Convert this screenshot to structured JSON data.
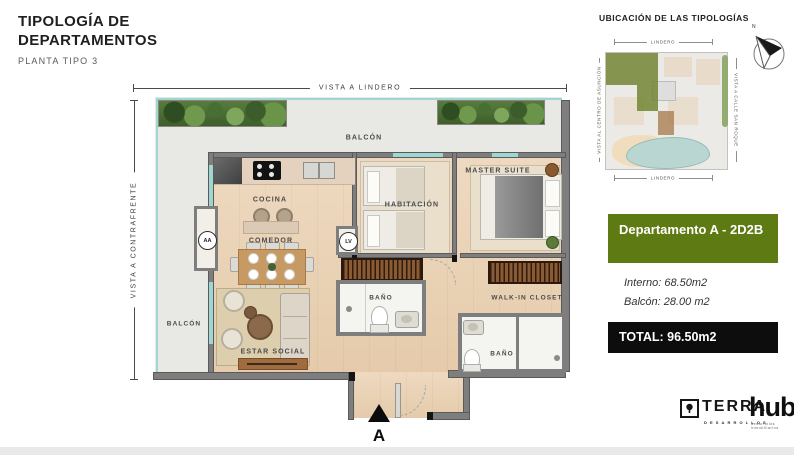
{
  "header": {
    "title_line1": "TIPOLOGÍA DE",
    "title_line2": "DEPARTAMENTOS",
    "subtitle": "PLANTA TIPO 3"
  },
  "plan": {
    "view_top": "VISTA A LINDERO",
    "view_left": "VISTA A CONTRAFRENTE",
    "balcony_top": "BALCÓN",
    "balcony_left": "BALCÓN",
    "kitchen": "COCINA",
    "dining": "COMEDOR",
    "living": "ESTAR SOCIAL",
    "bedroom": "HABITACIÓN",
    "master": "MASTER SUITE",
    "bath1": "BAÑO",
    "bath2": "BAÑO",
    "walkin": "WALK-IN CLOSET",
    "ac_unit": "AA",
    "laundry": "LV",
    "entry_label": "A"
  },
  "location": {
    "title": "UBICACIÓN DE LAS TIPOLOGÍAS",
    "boundary_top": "LINDERO",
    "boundary_bottom": "LINDERO",
    "view_left": "VISTA AL CENTRO DE ASUNCIÓN",
    "view_right": "VISTA A CALLE SAN ROQUE",
    "compass_n": "N"
  },
  "unit": {
    "name": "Departamento A - 2D2B",
    "interior_area": "Interno: 68.50m2",
    "balcony_area": "Balcón: 28.00 m2",
    "total_area": "TOTAL: 96.50m2"
  },
  "brand": {
    "terra": "TERRA",
    "terra_sub": "DESARROLLOS",
    "hub": "hub",
    "hub_reg": "®",
    "hub_sub": "desarrollos inmobiliarios"
  },
  "colors": {
    "olive": "#5e7a12",
    "total_bg": "#0d0d0d",
    "wall": "#7e7e7e",
    "wood_floor": "#e9d2b6",
    "glass": "#9fd6d2",
    "map_highlight": "rgba(110,130,45,0.8)"
  }
}
